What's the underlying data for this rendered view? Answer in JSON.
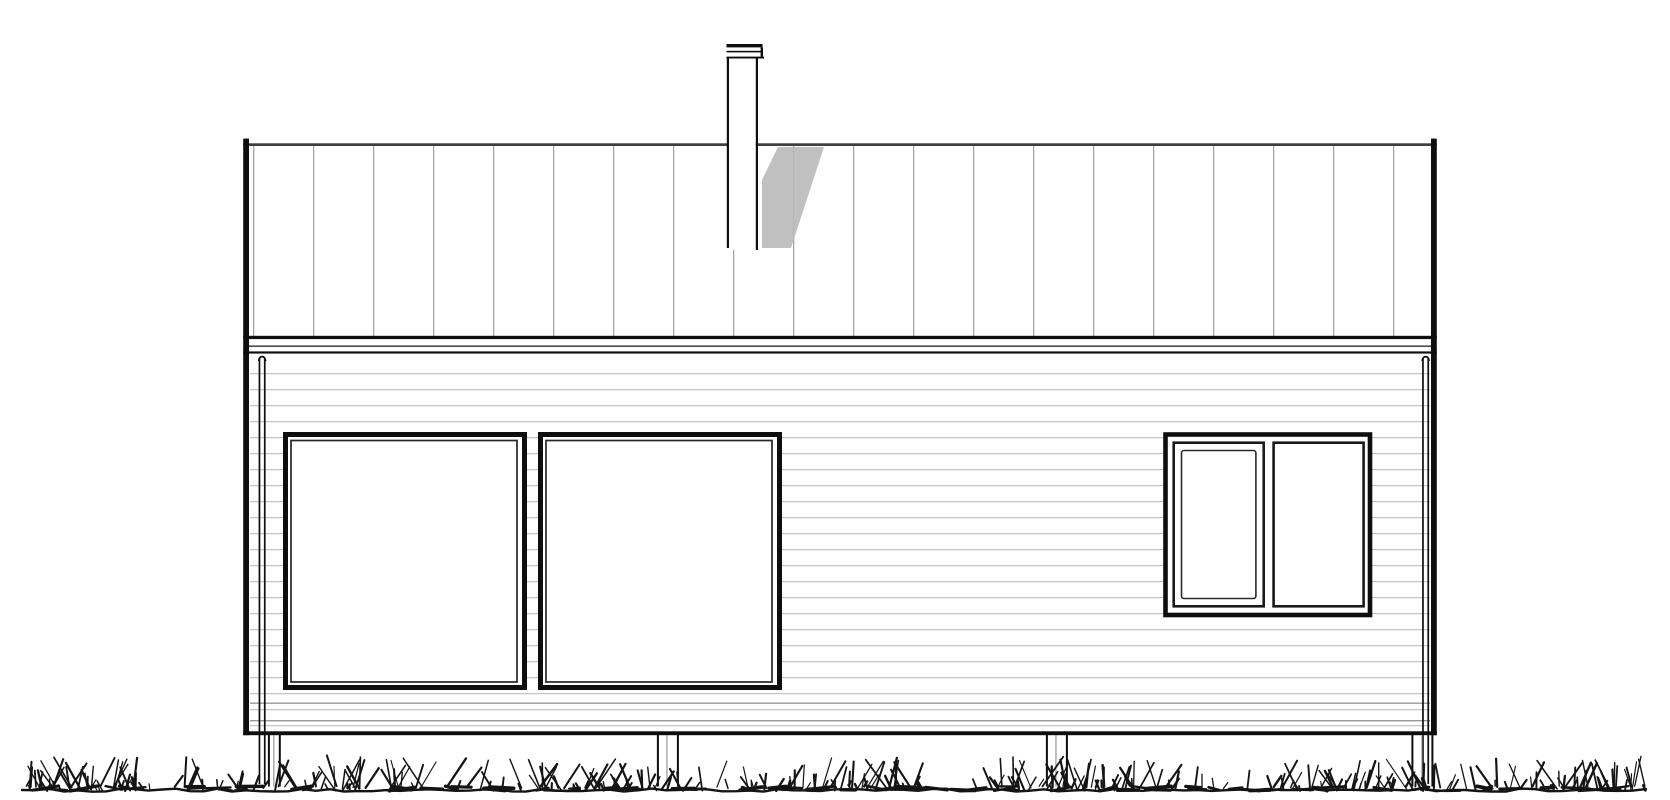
{
  "meta": {
    "title": "House elevation drawing",
    "drawing_type": "architectural elevation, long facade with standing-seam roof",
    "background": "#ffffff"
  },
  "colors": {
    "line_dark": "#0e0e0e",
    "line_medium": "#3f3f3f",
    "fascia_mid": "#4a4a4a",
    "seam_line": "#a6a6a6",
    "siding_line": "#c5c5c5",
    "siding_line_dark": "#9a9a9a",
    "shadow_gray": "#b9b9b9",
    "post_mid": "#8f8f8f",
    "grass_ink": "#141414"
  },
  "elements": {
    "roof": {
      "label": "standing-seam roof band",
      "seam_count": 20
    },
    "chimney": {
      "label": "chimney flue with cap",
      "count": 1,
      "has_shadow": true
    },
    "windows": [
      {
        "label": "large fixed window, left",
        "panes": 1
      },
      {
        "label": "large fixed window, center-left",
        "panes": 1
      },
      {
        "label": "double window, right: operable sash left + fixed pane right",
        "panes": 2
      }
    ],
    "downspouts": {
      "count": 2,
      "positions": [
        "left corner",
        "right corner"
      ]
    },
    "foundation_posts": {
      "count": 4
    },
    "ground": {
      "label": "sketched grass ground line"
    }
  },
  "decor": {
    "grass_seed": 20240613,
    "grass_blades": 560,
    "grass_dashes": 90,
    "grass_left": 22,
    "grass_right": 1648,
    "baseline_y": 790
  }
}
